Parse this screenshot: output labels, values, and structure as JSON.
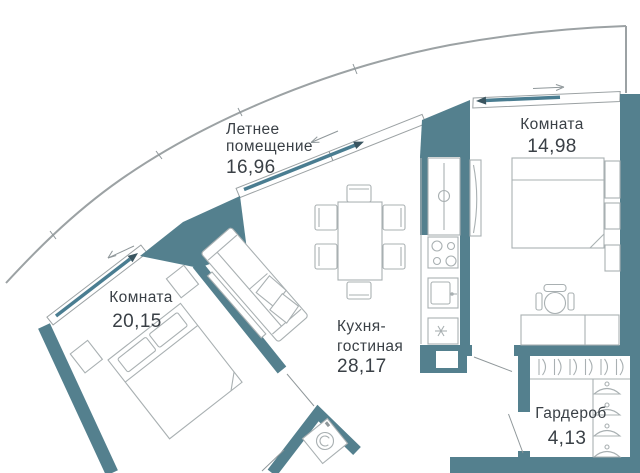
{
  "title": "Apartment floor plan",
  "rooms": [
    {
      "id": "terrace",
      "name_line1": "Летнее",
      "name_line2": "помещение",
      "area": "16,96"
    },
    {
      "id": "bedroom-right",
      "name": "Комната",
      "area": "14,98"
    },
    {
      "id": "bedroom-left",
      "name": "Комната",
      "area": "20,15"
    },
    {
      "id": "kitchen-living",
      "name_line1": "Кухня-",
      "name_line2": "гостиная",
      "area": "28,17"
    },
    {
      "id": "wardrobe",
      "name": "Гардероб",
      "area": "4,13"
    }
  ],
  "colors": {
    "wall": "#54808E",
    "glazing": "#4A7D91",
    "facade_line": "#9CA2A4",
    "furniture_line": "#A9B0B2",
    "text": "#3A4046",
    "background": "#ffffff"
  },
  "icons": [
    "sliding-window-arrow",
    "stove-burners",
    "sink",
    "dishwasher-asterisk",
    "washing-machine",
    "clothes-hanger",
    "door-leaf"
  ]
}
